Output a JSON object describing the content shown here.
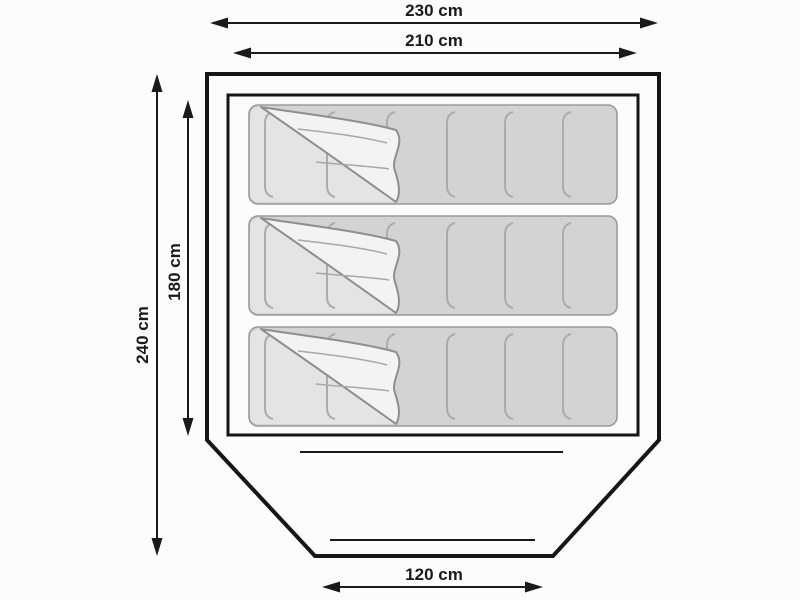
{
  "diagram": {
    "title": "Tent floor plan with three sleeping mats",
    "unit": "cm",
    "labels": {
      "outer_width": "230 cm",
      "inner_width": "210 cm",
      "outer_depth": "240 cm",
      "inner_depth": "180 cm",
      "entrance_width": "120 cm"
    },
    "values": {
      "outer_width": 230,
      "inner_width": 210,
      "outer_depth": 240,
      "inner_depth": 180,
      "entrance_width": 120
    },
    "sleeping_mats_count": 3,
    "colors": {
      "background": "#fcfcfc",
      "outline": "#161616",
      "arrow": "#1a1a1a",
      "mat_fill": "#d3d3d3",
      "mat_exposed_fill": "#e4e4e4",
      "flap_fill": "#f3f3f3",
      "mat_stroke": "#9a9a9a",
      "seam_stroke": "#ababab",
      "flap_stroke": "#8f8f8f"
    }
  }
}
